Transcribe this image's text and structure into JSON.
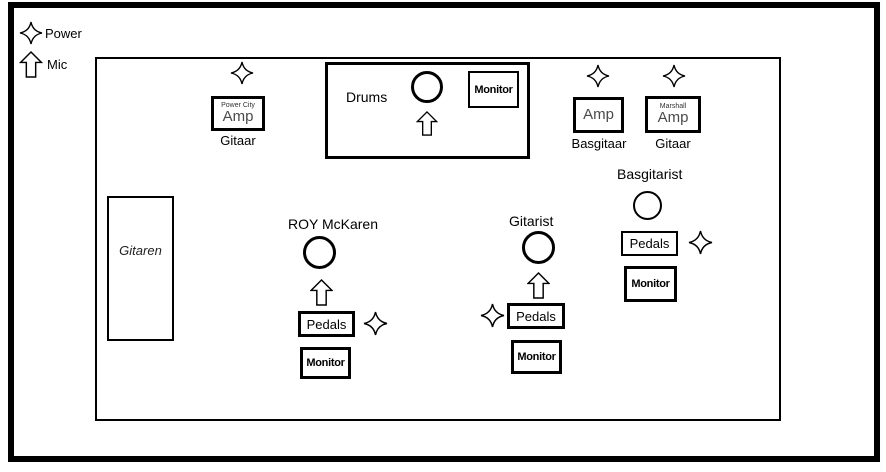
{
  "colors": {
    "line": "#000000",
    "bg": "#ffffff",
    "amp_text": "#4a4a4a"
  },
  "legend": {
    "power": "Power",
    "mic": "Mic"
  },
  "stage": {
    "guitar_amp": {
      "brand": "Power City",
      "label": "Amp",
      "instrument": "Gitaar"
    },
    "drums": {
      "label": "Drums",
      "monitor": "Monitor"
    },
    "bass_amp": {
      "label": "Amp",
      "instrument": "Basgitaar"
    },
    "marshall_amp": {
      "brand": "Marshall",
      "label": "Amp",
      "instrument": "Gitaar"
    },
    "guitar_rack": {
      "label": "Gitaren"
    },
    "vocalist": {
      "name": "ROY McKaren",
      "pedals": "Pedals",
      "monitor": "Monitor"
    },
    "guitarist": {
      "name": "Gitarist",
      "pedals": "Pedals",
      "monitor": "Monitor"
    },
    "bassist": {
      "name": "Basgitarist",
      "pedals": "Pedals",
      "monitor": "Monitor"
    }
  }
}
